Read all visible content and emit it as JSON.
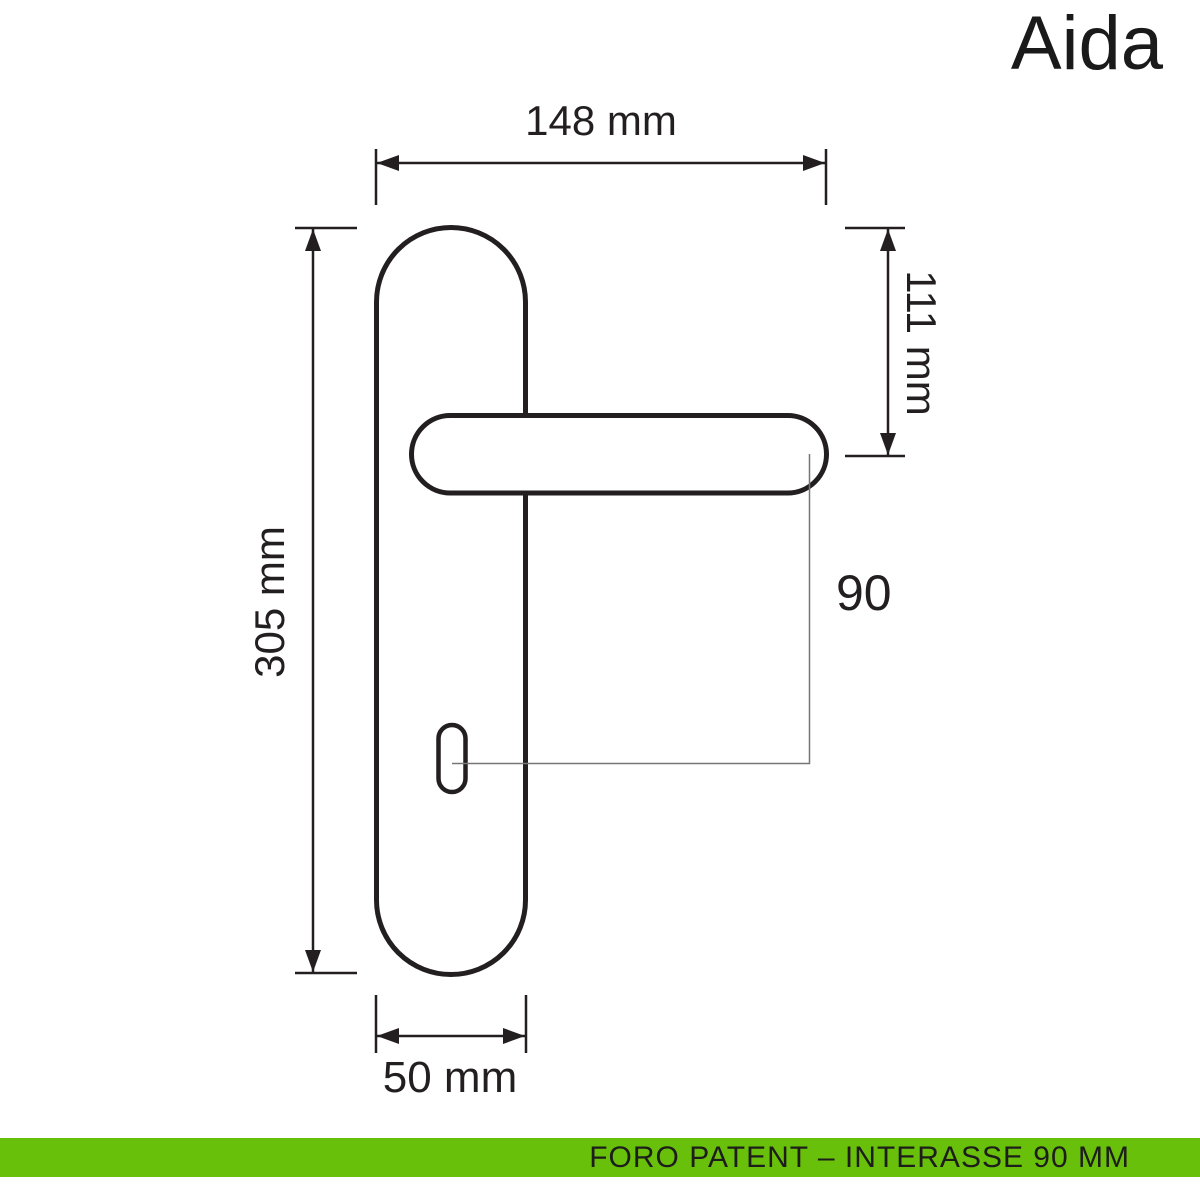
{
  "title": "Aida",
  "drawing": {
    "line_color": "#231f20",
    "leader_color": "#777777",
    "dimensions": {
      "total_width": "148 mm",
      "top_to_handle_axis": "111 mm",
      "plate_height": "305 mm",
      "handle_to_keyhole_interaxis": "90",
      "plate_width": "50 mm"
    }
  },
  "footer": {
    "label": "FORO PATENT – INTERASSE 90 MM",
    "bar_color": "#69c00a",
    "text_color": "#1d1d1b"
  }
}
